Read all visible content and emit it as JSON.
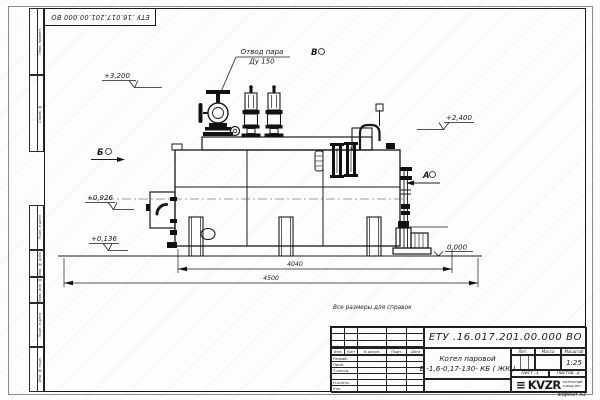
{
  "sheet": {
    "top_stamp": "ЕТУ .16.017.201.00.000  ВО",
    "reference_note": "Все размеры для справок",
    "format_label": "Формат А3",
    "margin_fields": [
      "Перв. примен.",
      "Справ. №",
      "Подп. и дата",
      "Инв. № дубл.",
      "Взам. инв. №",
      "Подп. и дата",
      "Инв. № подл."
    ]
  },
  "annotations": {
    "steam_outlet": {
      "line1": "Отвод пара",
      "line2": "Ду 150"
    },
    "levels": {
      "l3200": "+3,200",
      "l2400": "+2,400",
      "l0926": "+0,926",
      "l0136": "+0,136",
      "l0000": "0,000"
    },
    "views": {
      "top": "В",
      "left": "Б",
      "right": "А"
    },
    "dimensions": {
      "inner": "4040",
      "overall": "4500"
    }
  },
  "title_block": {
    "designation": "ЕТУ .16.017.201.00.000  ВО",
    "doc_name_line1": "Котел паровой",
    "doc_name_line2": "Е -1,6-0,17-130- КБ ( ЖК )",
    "columns": {
      "izm": "Изм.",
      "list": "Лист",
      "n_doc": "N докум.",
      "podp": "Подп.",
      "data": "Дата"
    },
    "rows": [
      "Разраб.",
      "Пров.",
      "Т.контр.",
      "",
      "Н.контр.",
      "Утв."
    ],
    "lit_label": "Лит.",
    "mass_label": "Масса",
    "scale_label": "Масштаб",
    "scale_value": "1:25",
    "sheet_label": "Лист",
    "sheet_value": "1",
    "sheets_label": "Листов",
    "sheets_value": "2",
    "logo_text": "KVZR",
    "logo_sub1": "КОТЕЛЬНЫЙ",
    "logo_sub2": "ЗАВОД РЭП"
  }
}
